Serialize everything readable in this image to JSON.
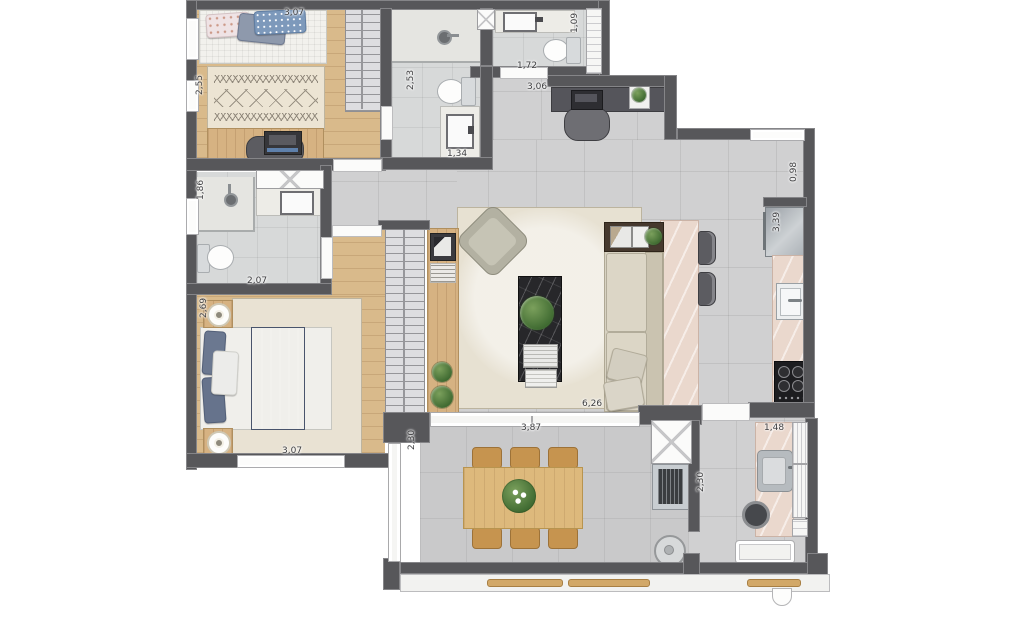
{
  "meta": {
    "type": "apartment-floor-plan",
    "style": "top-down furnished render"
  },
  "colors": {
    "wall": "#57575a",
    "tile_floor": "#d0d0d1",
    "wood_floor": "#dbbc8d",
    "counter_pink": "#ead8cd",
    "rug_beige": "#e7e1d2",
    "blanket_blue": "#5d6b86",
    "dining_wood": "#ddb97c",
    "plant_green": "#4e7c3d",
    "marble_dark": "#27272a"
  },
  "dimension_labels": [
    {
      "text": "3,07",
      "x": 284,
      "y": 8,
      "v": false
    },
    {
      "text": "2,55",
      "x": 195,
      "y": 95,
      "v": true
    },
    {
      "text": "2,53",
      "x": 406,
      "y": 90,
      "v": true
    },
    {
      "text": "1,34",
      "x": 447,
      "y": 149,
      "v": false
    },
    {
      "text": "1,09",
      "x": 570,
      "y": 33,
      "v": true
    },
    {
      "text": "1,72",
      "x": 517,
      "y": 61,
      "v": false
    },
    {
      "text": "3,06",
      "x": 527,
      "y": 82,
      "v": false
    },
    {
      "text": "0,98",
      "x": 789,
      "y": 182,
      "v": true
    },
    {
      "text": "3,39",
      "x": 772,
      "y": 232,
      "v": true
    },
    {
      "text": "1,86",
      "x": 196,
      "y": 200,
      "v": true
    },
    {
      "text": "2,07",
      "x": 247,
      "y": 276,
      "v": false
    },
    {
      "text": "2,69",
      "x": 199,
      "y": 318,
      "v": true
    },
    {
      "text": "3,07",
      "x": 282,
      "y": 446,
      "v": false
    },
    {
      "text": "6,26",
      "x": 582,
      "y": 399,
      "v": false
    },
    {
      "text": "3,87",
      "x": 521,
      "y": 423,
      "v": false
    },
    {
      "text": "2,30",
      "x": 407,
      "y": 450,
      "v": true
    },
    {
      "text": "2,30",
      "x": 696,
      "y": 492,
      "v": true
    },
    {
      "text": "1,48",
      "x": 764,
      "y": 423,
      "v": false
    }
  ]
}
